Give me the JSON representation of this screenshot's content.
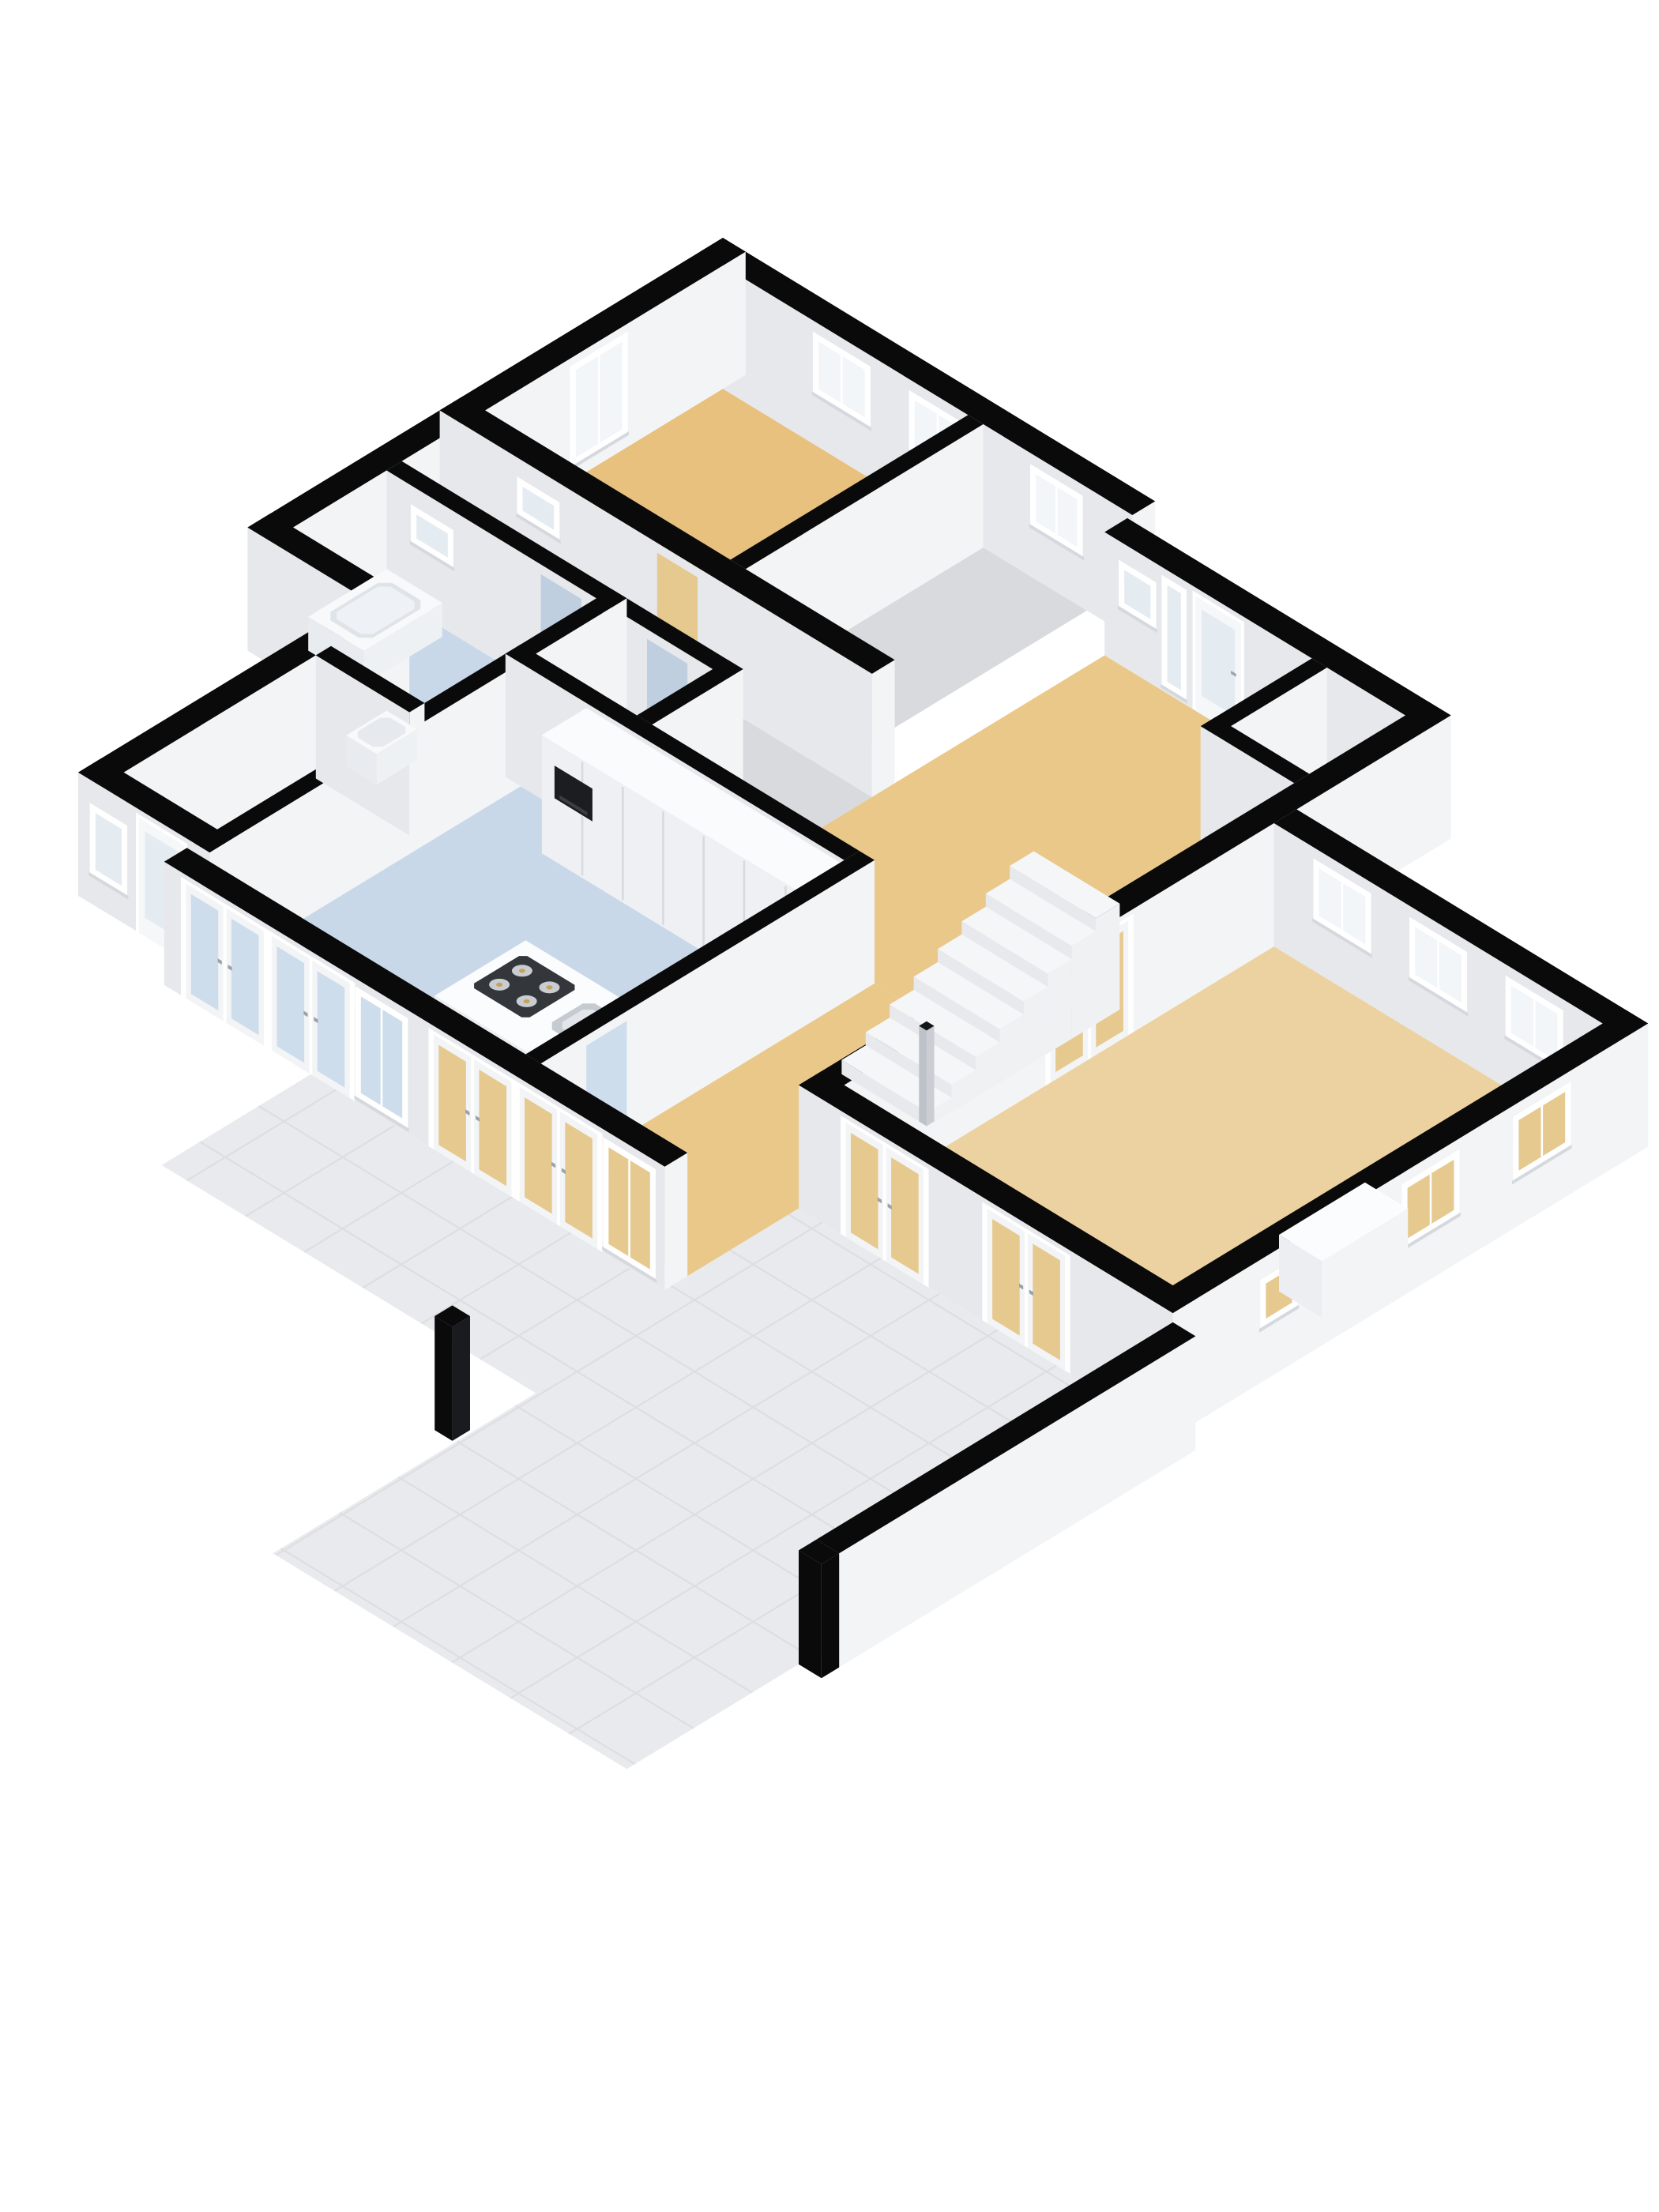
{
  "scene": {
    "kind": "3d-floorplan-render",
    "background": "#ffffff",
    "camera": "isometric-top-down"
  },
  "palette": {
    "wall_cut": "#0a0a0b",
    "wall_face_se": "#f2f4f6",
    "wall_face_sw": "#e6e8ec",
    "wall_top_white": "#fafbfc",
    "floor_tan": "#e7c17d",
    "floor_tan_light": "#ecd2a0",
    "floor_tan_hall": "#eac88a",
    "floor_blue": "#c8d8e8",
    "floor_gray": "#d8dadd",
    "terrace_tile": "#e9eaed",
    "terrace_grid": "#dcdee2",
    "glass_bright": "#f2f6f9",
    "glass_frost": "#e4ebf1",
    "glass_tan": "#e6c98f",
    "glass_blue": "#cdddeb",
    "frame_white": "#ffffff",
    "cabinet_face": "#eef0f3",
    "cabinet_seam": "#d6d9dd",
    "oven_black": "#1b1d21",
    "stove_black": "#33373c",
    "burner_ring": "#c9ccd1",
    "burner_dot": "#c8a159",
    "steel": "#c3c8ce",
    "newel_gray": "#caced4"
  },
  "rooms": [
    {
      "id": "bedroom",
      "name": "bedroom",
      "floor": "floor_tan"
    },
    {
      "id": "closet-room",
      "name": "closet",
      "floor": "floor_gray"
    },
    {
      "id": "corridor",
      "name": "corridor",
      "floor": "floor_gray"
    },
    {
      "id": "bathroom",
      "name": "bathroom",
      "floor": "floor_blue"
    },
    {
      "id": "wc",
      "name": "wc",
      "floor": "floor_blue"
    },
    {
      "id": "utility",
      "name": "utility-room",
      "floor": "floor_blue"
    },
    {
      "id": "kitchen",
      "name": "kitchen",
      "floor": "floor_blue"
    },
    {
      "id": "hallway",
      "name": "hallway-dining",
      "floor": "floor_tan_hall"
    },
    {
      "id": "entry-niche",
      "name": "entry-niche",
      "floor": "floor_gray"
    },
    {
      "id": "living",
      "name": "living-room",
      "floor": "floor_tan_light"
    },
    {
      "id": "terrace",
      "name": "terrace",
      "floor": "terrace_tile"
    }
  ],
  "furniture": [
    {
      "id": "tall-cabinets",
      "name": "tall kitchen cabinets"
    },
    {
      "id": "built-in-oven",
      "name": "built-in oven"
    },
    {
      "id": "kitchen-island",
      "name": "kitchen island"
    },
    {
      "id": "gas-stove",
      "name": "4-burner gas stove"
    },
    {
      "id": "kitchen-sink",
      "name": "kitchen sink with faucet"
    },
    {
      "id": "bathtub",
      "name": "bathtub"
    },
    {
      "id": "wash-basin",
      "name": "wash basin"
    },
    {
      "id": "staircase",
      "name": "staircase"
    },
    {
      "id": "newel-post",
      "name": "newel post"
    },
    {
      "id": "low-cabinet",
      "name": "low cabinet block"
    },
    {
      "id": "garden-wall",
      "name": "garden wall"
    },
    {
      "id": "cut-post",
      "name": "cut wall post"
    }
  ]
}
